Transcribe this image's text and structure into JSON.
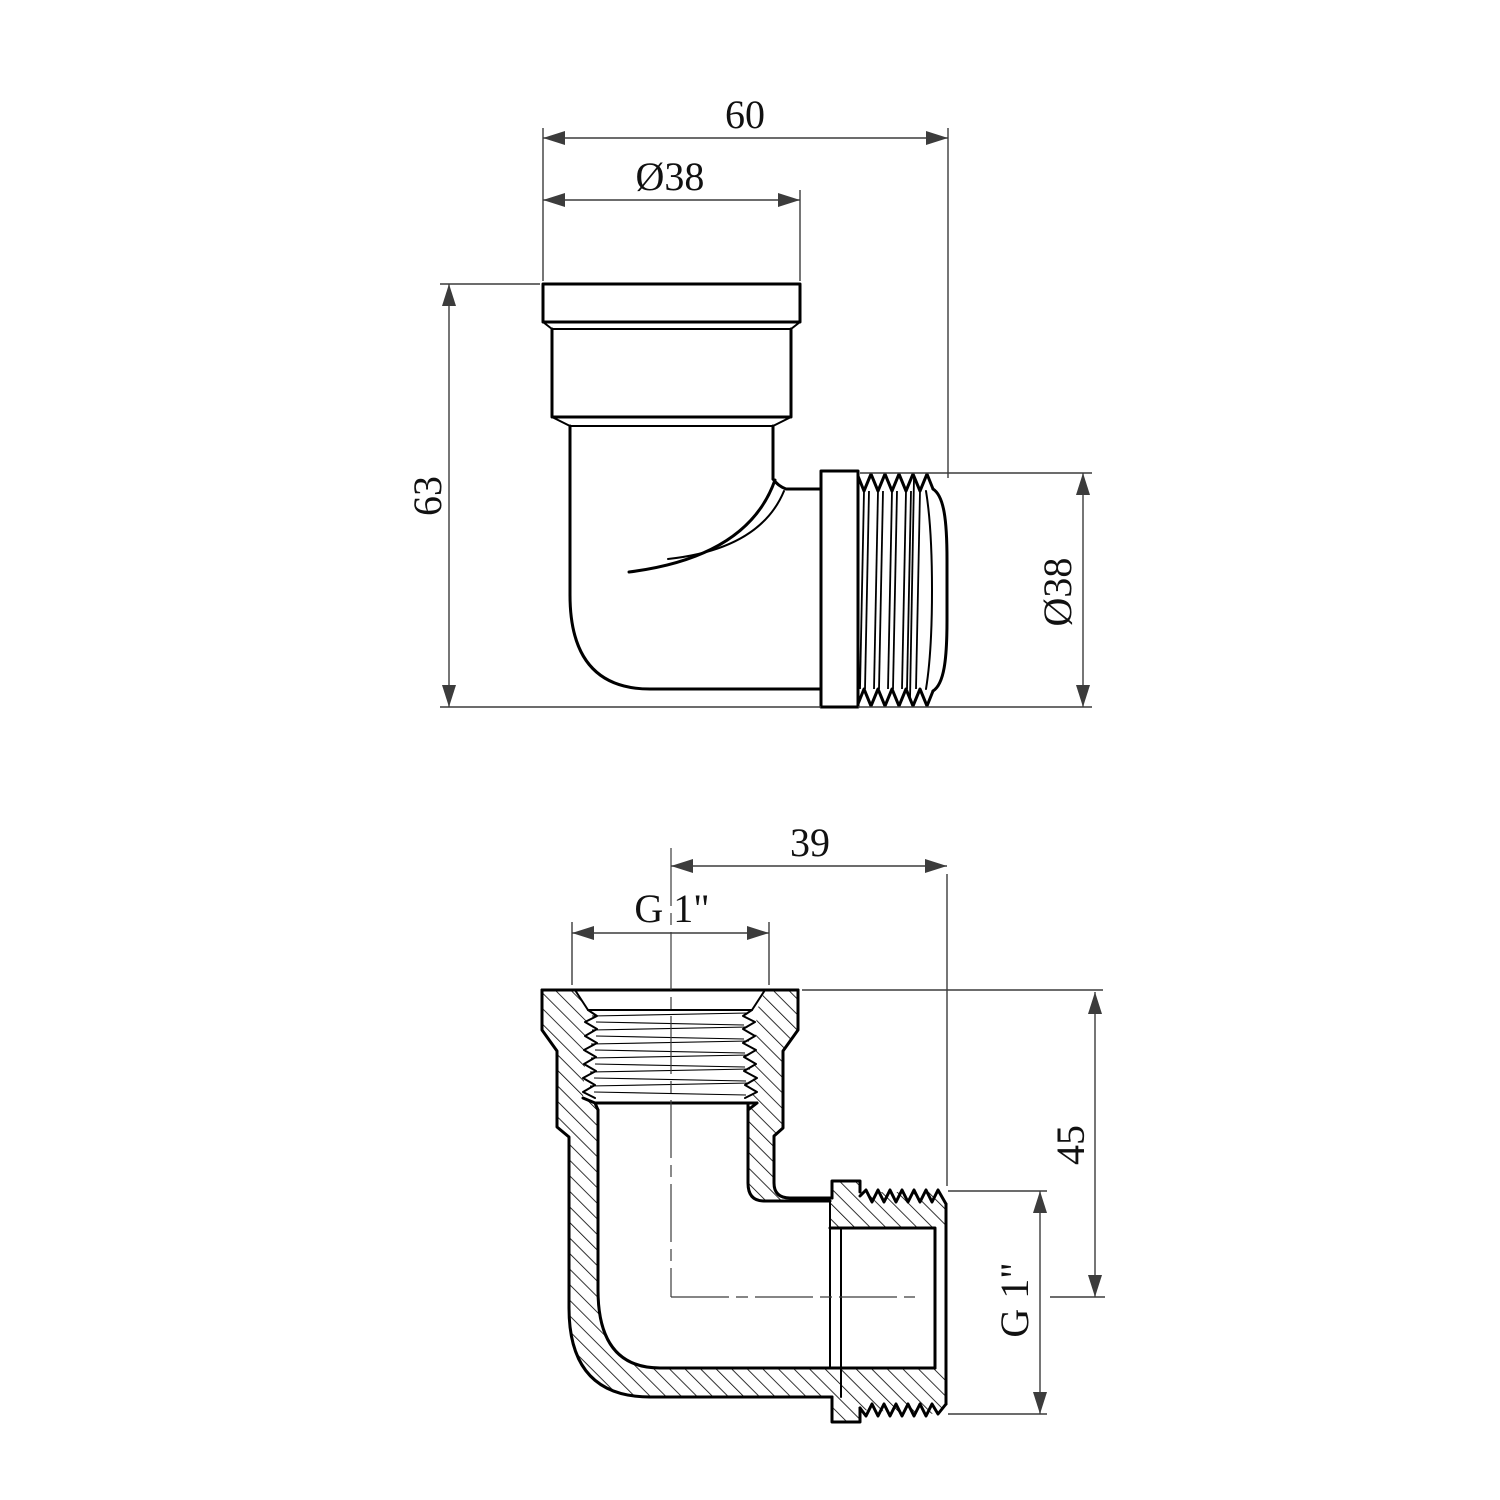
{
  "drawing": {
    "type": "technical-drawing",
    "description": "Two orthographic views of a 90-degree threaded pipe elbow: external view (top) and cross-section view (bottom)",
    "colors": {
      "line": "#000000",
      "dim": "#3c3c3c",
      "background": "#ffffff"
    },
    "top_view": {
      "name": "external-view",
      "dim_width": {
        "label": "60"
      },
      "dim_top_diameter": {
        "label": "Ø38"
      },
      "dim_height": {
        "label": "63"
      },
      "dim_side_diameter": {
        "label": "Ø38"
      }
    },
    "section_view": {
      "name": "section-view",
      "dim_length": {
        "label": "39"
      },
      "dim_top_thread": {
        "label": "G 1\""
      },
      "dim_axis_height": {
        "label": "45"
      },
      "dim_side_thread": {
        "label": "G 1\""
      }
    }
  }
}
